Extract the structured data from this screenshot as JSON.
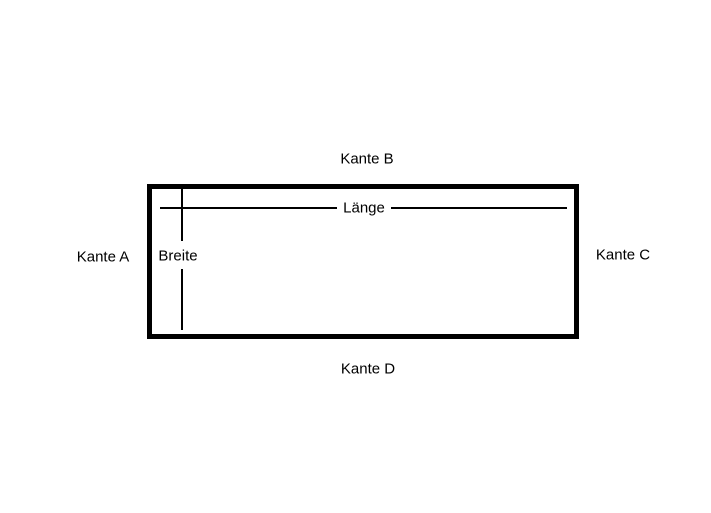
{
  "diagram": {
    "background_color": "#ffffff",
    "line_color": "#000000",
    "shape": "rectangle",
    "labels": {
      "edge_left": "Kante A",
      "edge_top": "Kante B",
      "edge_right": "Kante C",
      "edge_bottom": "Kante D",
      "dimension_horizontal": "Länge",
      "dimension_vertical": "Breite"
    }
  }
}
